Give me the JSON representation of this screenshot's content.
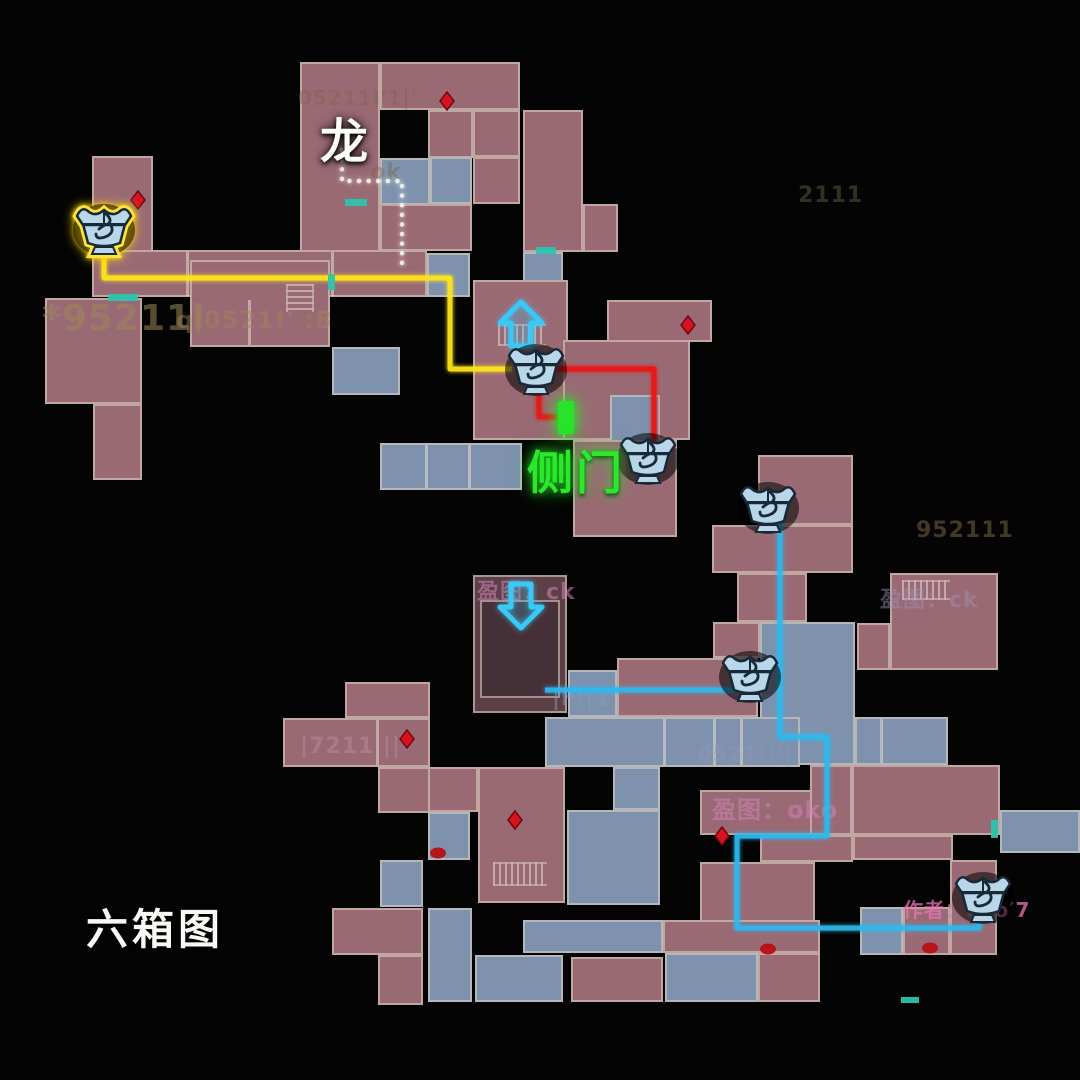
{
  "map_title": {
    "text": "六箱图"
  },
  "labels": {
    "dragon": {
      "text": "龙"
    },
    "side_door": {
      "text": "侧门"
    }
  },
  "map": {
    "background": "#040404",
    "room_border": "#dbd1c1",
    "colors": {
      "p": "#9a6a74",
      "b": "#7e92ae",
      "d": "#5c3f47",
      "d2": "#463038"
    },
    "rooms": [
      [
        300,
        62,
        80,
        190,
        "p"
      ],
      [
        380,
        62,
        140,
        48,
        "p"
      ],
      [
        473,
        110,
        47,
        47,
        "p"
      ],
      [
        428,
        110,
        45,
        48,
        "p"
      ],
      [
        380,
        158,
        50,
        47,
        "b"
      ],
      [
        430,
        157,
        42,
        47,
        "b"
      ],
      [
        473,
        157,
        47,
        47,
        "p"
      ],
      [
        380,
        204,
        92,
        47,
        "p"
      ],
      [
        523,
        110,
        60,
        142,
        "p"
      ],
      [
        583,
        204,
        35,
        48,
        "p"
      ],
      [
        523,
        252,
        40,
        38,
        "b"
      ],
      [
        92,
        156,
        61,
        96,
        "p"
      ],
      [
        92,
        250,
        335,
        47,
        "p"
      ],
      [
        427,
        253,
        43,
        44,
        "b"
      ],
      [
        45,
        298,
        97,
        106,
        "p"
      ],
      [
        93,
        404,
        49,
        76,
        "p"
      ],
      [
        190,
        260,
        140,
        87,
        "p"
      ],
      [
        332,
        347,
        68,
        48,
        "b"
      ],
      [
        473,
        280,
        95,
        160,
        "p"
      ],
      [
        380,
        443,
        142,
        47,
        "b"
      ],
      [
        563,
        340,
        127,
        100,
        "p"
      ],
      [
        610,
        395,
        50,
        48,
        "b"
      ],
      [
        607,
        300,
        105,
        42,
        "p"
      ],
      [
        573,
        440,
        104,
        97,
        "p"
      ],
      [
        758,
        455,
        95,
        70,
        "p"
      ],
      [
        712,
        525,
        141,
        48,
        "p"
      ],
      [
        737,
        573,
        70,
        49,
        "p"
      ],
      [
        890,
        573,
        108,
        97,
        "p"
      ],
      [
        857,
        623,
        33,
        47,
        "p"
      ],
      [
        760,
        622,
        95,
        143,
        "b"
      ],
      [
        855,
        717,
        93,
        48,
        "b"
      ],
      [
        1000,
        810,
        80,
        43,
        "b"
      ],
      [
        473,
        575,
        94,
        138,
        "d"
      ],
      [
        480,
        600,
        80,
        98,
        "d2"
      ],
      [
        713,
        622,
        47,
        36,
        "p"
      ],
      [
        617,
        658,
        141,
        59,
        "p"
      ],
      [
        568,
        670,
        49,
        47,
        "b"
      ],
      [
        545,
        717,
        255,
        50,
        "b"
      ],
      [
        613,
        767,
        47,
        43,
        "b"
      ],
      [
        567,
        810,
        93,
        95,
        "b"
      ],
      [
        700,
        790,
        112,
        45,
        "p"
      ],
      [
        810,
        765,
        42,
        70,
        "p"
      ],
      [
        852,
        765,
        148,
        70,
        "p"
      ],
      [
        700,
        862,
        115,
        66,
        "p"
      ],
      [
        760,
        835,
        93,
        27,
        "p"
      ],
      [
        853,
        835,
        100,
        25,
        "p"
      ],
      [
        950,
        860,
        47,
        95,
        "p"
      ],
      [
        860,
        907,
        43,
        48,
        "b"
      ],
      [
        903,
        907,
        47,
        48,
        "p"
      ],
      [
        283,
        718,
        147,
        49,
        "p"
      ],
      [
        345,
        682,
        85,
        36,
        "p"
      ],
      [
        378,
        767,
        52,
        46,
        "p"
      ],
      [
        428,
        767,
        50,
        45,
        "p"
      ],
      [
        478,
        767,
        87,
        136,
        "p"
      ],
      [
        428,
        812,
        42,
        48,
        "b"
      ],
      [
        380,
        860,
        43,
        47,
        "b"
      ],
      [
        332,
        908,
        91,
        47,
        "p"
      ],
      [
        378,
        955,
        45,
        50,
        "p"
      ],
      [
        428,
        908,
        44,
        94,
        "b"
      ],
      [
        475,
        955,
        88,
        47,
        "b"
      ],
      [
        523,
        920,
        140,
        33,
        "b"
      ],
      [
        571,
        957,
        92,
        45,
        "p"
      ],
      [
        665,
        953,
        93,
        49,
        "b"
      ],
      [
        663,
        920,
        157,
        33,
        "p"
      ],
      [
        758,
        953,
        62,
        49,
        "p"
      ]
    ],
    "dividers": [
      [
        186,
        252,
        3,
        44
      ],
      [
        331,
        252,
        3,
        44
      ],
      [
        248,
        300,
        3,
        45
      ],
      [
        425,
        445,
        3,
        43
      ],
      [
        468,
        445,
        3,
        43
      ],
      [
        663,
        719,
        3,
        46
      ],
      [
        713,
        719,
        3,
        46
      ],
      [
        740,
        719,
        3,
        46
      ],
      [
        880,
        719,
        3,
        44
      ],
      [
        376,
        720,
        3,
        45
      ]
    ],
    "stairs": [
      {
        "x": 286,
        "y": 284,
        "w": 24,
        "h": 28,
        "dir": "v"
      },
      {
        "x": 498,
        "y": 324,
        "w": 48,
        "h": 18,
        "dir": "h"
      },
      {
        "x": 493,
        "y": 862,
        "w": 54,
        "h": 20,
        "dir": "h"
      },
      {
        "x": 902,
        "y": 580,
        "w": 48,
        "h": 16,
        "dir": "h"
      }
    ],
    "routes": [
      {
        "name": "route-yellow",
        "color": "#ffe619",
        "width": 5,
        "style": "solid",
        "points": [
          [
            104,
            252
          ],
          [
            104,
            278
          ],
          [
            450,
            278
          ],
          [
            450,
            369
          ],
          [
            512,
            369
          ]
        ]
      },
      {
        "name": "route-red-main",
        "color": "#ec1414",
        "width": 5,
        "style": "solid",
        "points": [
          [
            556,
            369
          ],
          [
            654,
            369
          ],
          [
            654,
            446
          ]
        ]
      },
      {
        "name": "route-red-branch",
        "color": "#ec1414",
        "width": 5,
        "style": "solid",
        "points": [
          [
            539,
            387
          ],
          [
            539,
            417
          ],
          [
            557,
            417
          ]
        ]
      },
      {
        "name": "route-cyan-main",
        "color": "#2db9ee",
        "width": 5,
        "style": "solid",
        "points": [
          [
            780,
            521
          ],
          [
            780,
            737
          ],
          [
            827,
            737
          ],
          [
            827,
            836
          ],
          [
            737,
            836
          ],
          [
            737,
            928
          ],
          [
            979,
            928
          ],
          [
            979,
            912
          ]
        ]
      },
      {
        "name": "route-cyan-branch",
        "color": "#2db9ee",
        "width": 5,
        "style": "solid",
        "points": [
          [
            545,
            690
          ],
          [
            755,
            690
          ]
        ]
      },
      {
        "name": "route-dotted-white",
        "color": "#f2f2ec",
        "width": 4.5,
        "style": "dotted",
        "points": [
          [
            342,
            150
          ],
          [
            342,
            181
          ],
          [
            402,
            181
          ],
          [
            402,
            266
          ]
        ]
      }
    ],
    "chests": [
      {
        "x": 104,
        "y": 229,
        "highlight": true
      },
      {
        "x": 536,
        "y": 369,
        "highlight": false
      },
      {
        "x": 648,
        "y": 458,
        "highlight": false
      },
      {
        "x": 768,
        "y": 507,
        "highlight": false
      },
      {
        "x": 750,
        "y": 676,
        "highlight": false
      },
      {
        "x": 983,
        "y": 897,
        "highlight": false
      }
    ],
    "arrows": [
      {
        "x": 521,
        "y": 325,
        "dir": "up"
      },
      {
        "x": 521,
        "y": 605,
        "dir": "down"
      }
    ],
    "green_door": {
      "x": 558,
      "y": 401,
      "w": 16,
      "h": 33,
      "color": "#28e428"
    },
    "diamonds": [
      [
        447,
        101
      ],
      [
        138,
        200
      ],
      [
        688,
        325
      ],
      [
        407,
        739
      ],
      [
        515,
        820
      ],
      [
        722,
        836
      ]
    ],
    "blobs": [
      [
        438,
        853
      ],
      [
        768,
        949
      ],
      [
        930,
        948
      ]
    ],
    "teal_doors": [
      [
        108,
        294,
        30,
        7
      ],
      [
        345,
        199,
        22,
        7
      ],
      [
        536,
        247,
        20,
        7
      ],
      [
        328,
        274,
        7,
        16
      ],
      [
        991,
        820,
        7,
        18
      ],
      [
        901,
        997,
        18,
        6
      ]
    ],
    "watermarks": [
      {
        "t": "*95211l",
        "x": 42,
        "y": 298,
        "s": 36,
        "c": "#9c8758",
        "o": 0.55
      },
      {
        "t": "q|0521!' :8",
        "x": 176,
        "y": 306,
        "s": 24,
        "c": "#9c8758",
        "o": 0.45
      },
      {
        "t": "05211l'1|'",
        "x": 298,
        "y": 86,
        "s": 20,
        "c": "#7a6748",
        "o": 0.4
      },
      {
        "t": "2111",
        "x": 798,
        "y": 183,
        "s": 22,
        "c": "#6b7a4e",
        "o": 0.4
      },
      {
        "t": "ok",
        "x": 370,
        "y": 160,
        "s": 22,
        "c": "#7a6748",
        "o": 0.4
      },
      {
        "t": "盈图：ck",
        "x": 477,
        "y": 574,
        "s": 22,
        "c": "#d183b8",
        "o": 0.55
      },
      {
        "t": "盈图：oko",
        "x": 712,
        "y": 790,
        "s": 24,
        "c": "#d183b8",
        "o": 0.55
      },
      {
        "t": "盈图：ck",
        "x": 880,
        "y": 582,
        "s": 22,
        "c": "#a192b8",
        "o": 0.45
      },
      {
        "t": "作者：oko′7",
        "x": 903,
        "y": 894,
        "s": 20,
        "c": "#ea74b8",
        "o": 0.75
      },
      {
        "t": "952111",
        "x": 916,
        "y": 518,
        "s": 22,
        "c": "#9c8758",
        "o": 0.4
      },
      {
        "t": "|F:|1",
        "x": 552,
        "y": 686,
        "s": 22,
        "c": "#8b9bb5",
        "o": 0.5
      },
      {
        "t": "0521!!'|",
        "x": 698,
        "y": 742,
        "s": 20,
        "c": "#8d99b5",
        "o": 0.5
      },
      {
        "t": "|7211 ||",
        "x": 300,
        "y": 734,
        "s": 22,
        "c": "#b790a0",
        "o": 0.45
      }
    ]
  }
}
